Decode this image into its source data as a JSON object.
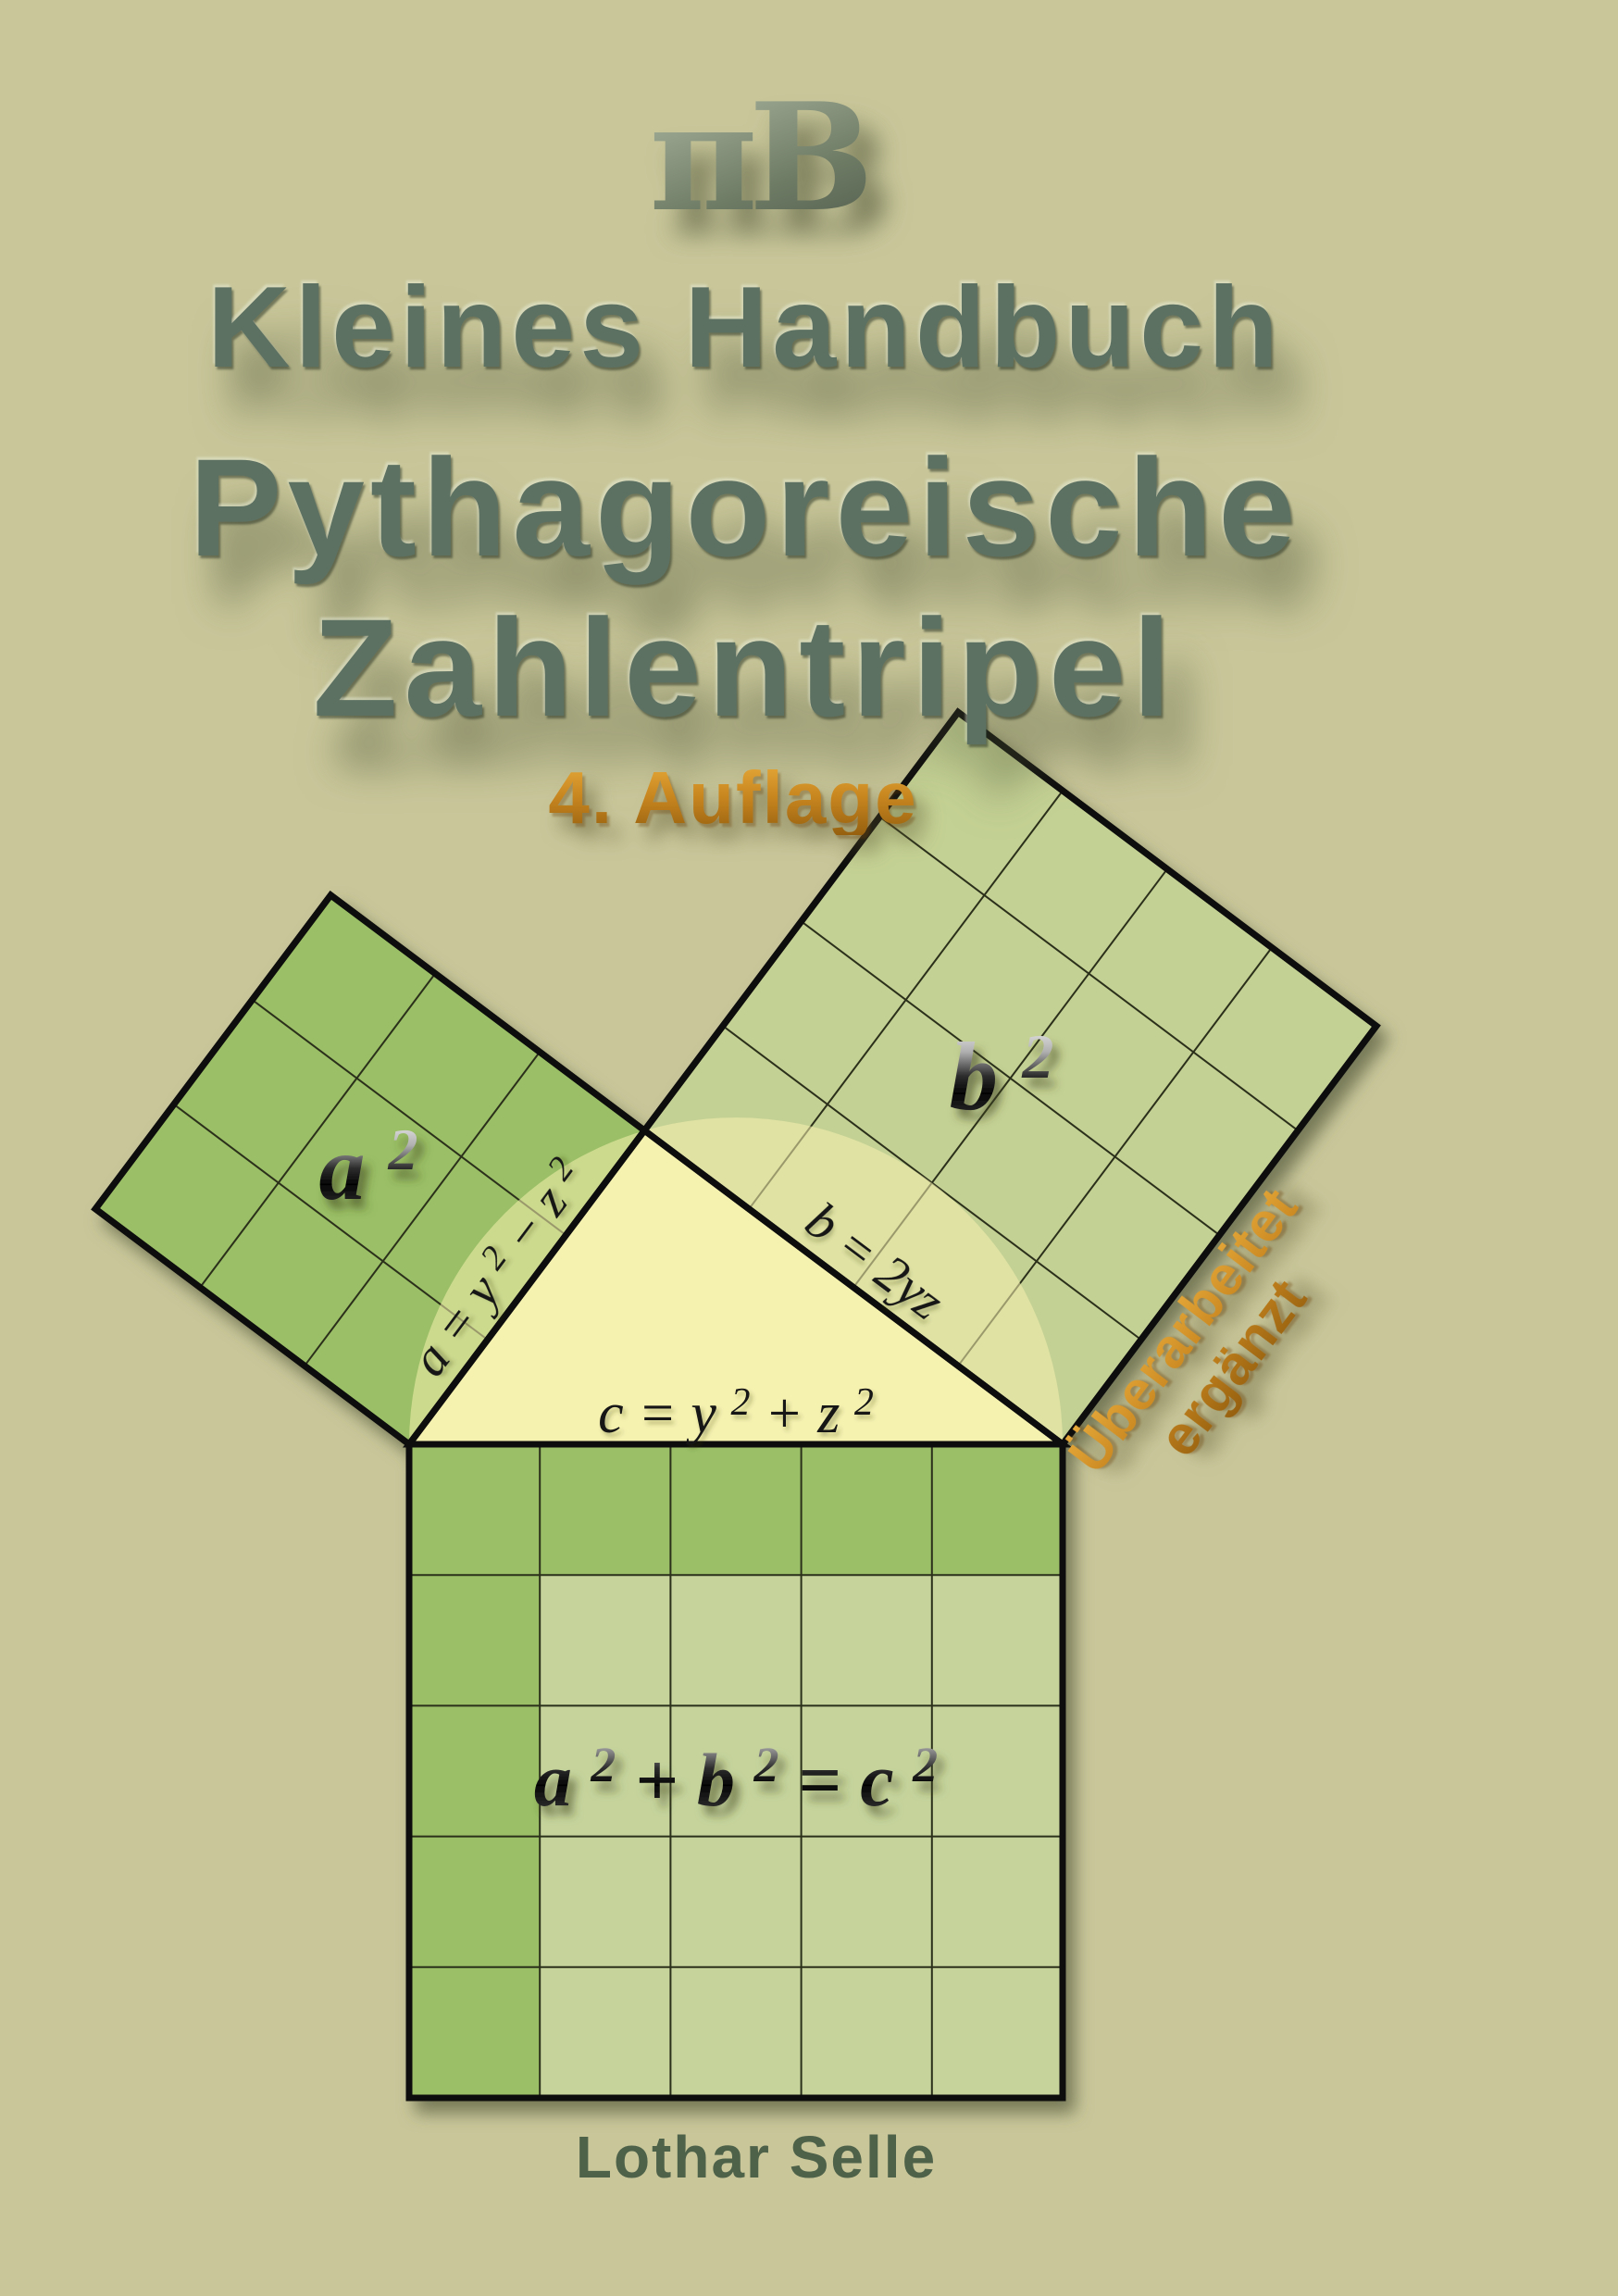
{
  "page": {
    "background": "#c9c79a"
  },
  "logo": {
    "text": "πB"
  },
  "title": {
    "line1": "Kleines Handbuch",
    "line2": "Pythagoreische",
    "line3": "Zahlentripel"
  },
  "edition": {
    "text": "4. Auflage"
  },
  "badge": {
    "line1": "Überarbeitet",
    "line2": "ergänzt"
  },
  "author": {
    "name": "Lothar Selle"
  },
  "diagram": {
    "square_a_label": {
      "base": "a",
      "sup": "2"
    },
    "square_b_label": {
      "base": "b",
      "sup": "2"
    },
    "equation_parts": [
      "a",
      "2",
      " + b",
      "2",
      " = c",
      "2"
    ],
    "leg_a_parts": [
      "a = y",
      "2",
      "− z",
      "2"
    ],
    "leg_b_label": "b = 2yz",
    "hyp_parts": [
      "c = y",
      "2",
      " + z",
      "2"
    ],
    "colors": {
      "background": "#c9c79a",
      "square_dark_green": "#9abf66",
      "square_b_green": "#c4d194",
      "square_c_light": "#c6d49c",
      "triangle_yellow": "#f5f1af",
      "outline_black": "#0d0d0d",
      "grid_olive": "#2b301b",
      "title_green": "#5d7162",
      "accent_orange": "#c8861f",
      "author_green": "#4e6149"
    }
  }
}
